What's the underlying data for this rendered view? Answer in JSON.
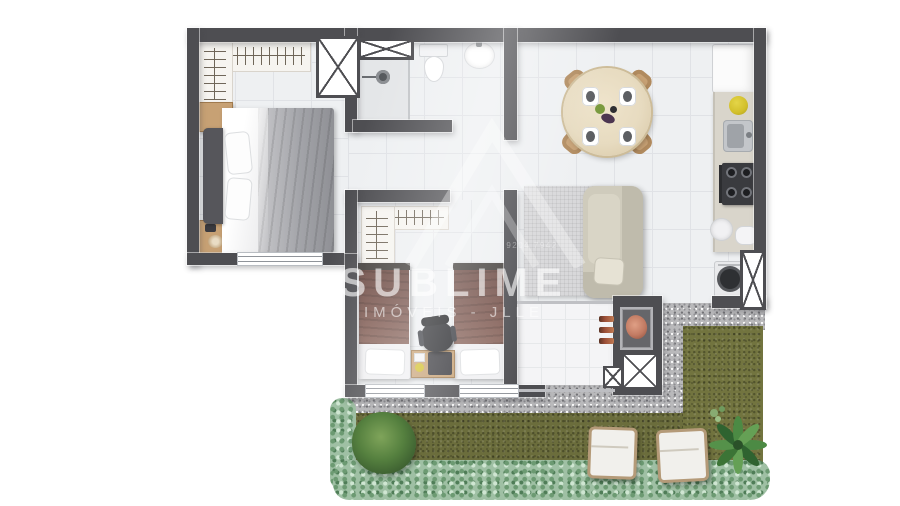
{
  "watermark": {
    "brand": "SUBLIME",
    "subtitle": "IMÓVEIS - JLLE",
    "phone": "9204 7942"
  },
  "legend": {
    "rooms": [
      "master-bedroom",
      "bathroom",
      "hall",
      "second-bedroom",
      "living-dining",
      "kitchen",
      "laundry-nook",
      "gourmet-balcony-bbq",
      "garden-terrace"
    ],
    "furniture": [
      "double-bed",
      "wardrobes",
      "nightstands",
      "shower",
      "toilet",
      "sink",
      "twin-beds",
      "desk",
      "office-chair",
      "round-dining-table",
      "four-chairs",
      "l-sofa",
      "rug",
      "fridge",
      "cooktop",
      "kitchen-sink",
      "washing-machine",
      "bbq-grill",
      "lounge-chairs",
      "plants",
      "hedges"
    ]
  },
  "palette": {
    "wall": "#4e4e52",
    "floor": "#eef0f2",
    "floorline": "#e0e2e6",
    "varanda": "#f4f4f6",
    "gravel": "#b9b9bb",
    "grass1": "#6b6d3c",
    "grass2": "#72743f",
    "hedge": "#9fc0a4",
    "wood": "#c7a174",
    "woodd": "#a07a4e",
    "duvet1": "#a3a4a9",
    "headboard": "#56565b",
    "duvet2": "#7f5b53",
    "sofa": "#cfcbbc",
    "sofaback": "#bfbbac",
    "rug": "#d8d8da",
    "table": "#e7dbc0",
    "counter": "#d9d5cb",
    "stove": "#3a3b3f",
    "fridge": "#fbfbfb",
    "meat": "#c27b63",
    "redbar": "#9c4f38",
    "yellow": "#d2bf2a"
  }
}
